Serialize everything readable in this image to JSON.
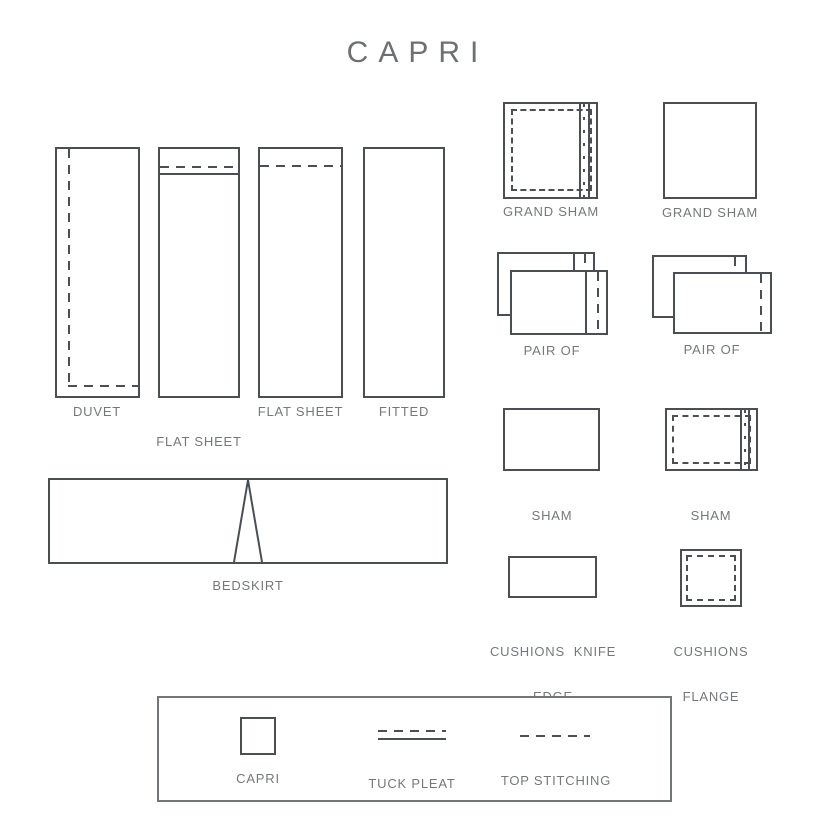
{
  "title": "CAPRI",
  "colors": {
    "line": "#4b4e52",
    "text": "#75787b",
    "legend_border": "#737679",
    "background": "#ffffff"
  },
  "diagrams": {
    "duvet": {
      "label": "DUVET"
    },
    "flat_sheet_tuck_pleat": {
      "label_line1": "FLAT SHEET",
      "label_line2": "TUCK PLEAT"
    },
    "flat_sheet": {
      "label": "FLAT SHEET"
    },
    "fitted": {
      "label": "FITTED"
    },
    "bedskirt": {
      "label": "BEDSKIRT"
    },
    "grand_sham_flange": {
      "label": "GRAND SHAM"
    },
    "grand_sham_plain": {
      "label": "GRAND SHAM"
    },
    "pair_of_left": {
      "label": "PAIR OF"
    },
    "pair_of_right": {
      "label": "PAIR OF"
    },
    "sham_knife_edge": {
      "label_line1": "SHAM",
      "label_line2": "KNIFE EDGE"
    },
    "sham_flange": {
      "label_line1": "SHAM",
      "label_line2": "FLANGE"
    },
    "cushions_knife_edge": {
      "label_line1": "CUSHIONS  KNIFE",
      "label_line2": "EDGE"
    },
    "cushions_flange": {
      "label_line1": "CUSHIONS",
      "label_line2": "FLANGE"
    }
  },
  "legend": {
    "capri": {
      "label": "CAPRI",
      "swatch": "square-outline"
    },
    "tuck_pleat": {
      "label": "TUCK PLEAT",
      "swatch": "dashed-line-over-solid-line"
    },
    "top_stitching": {
      "label": "TOP STITCHING",
      "swatch": "dashed-line"
    }
  }
}
